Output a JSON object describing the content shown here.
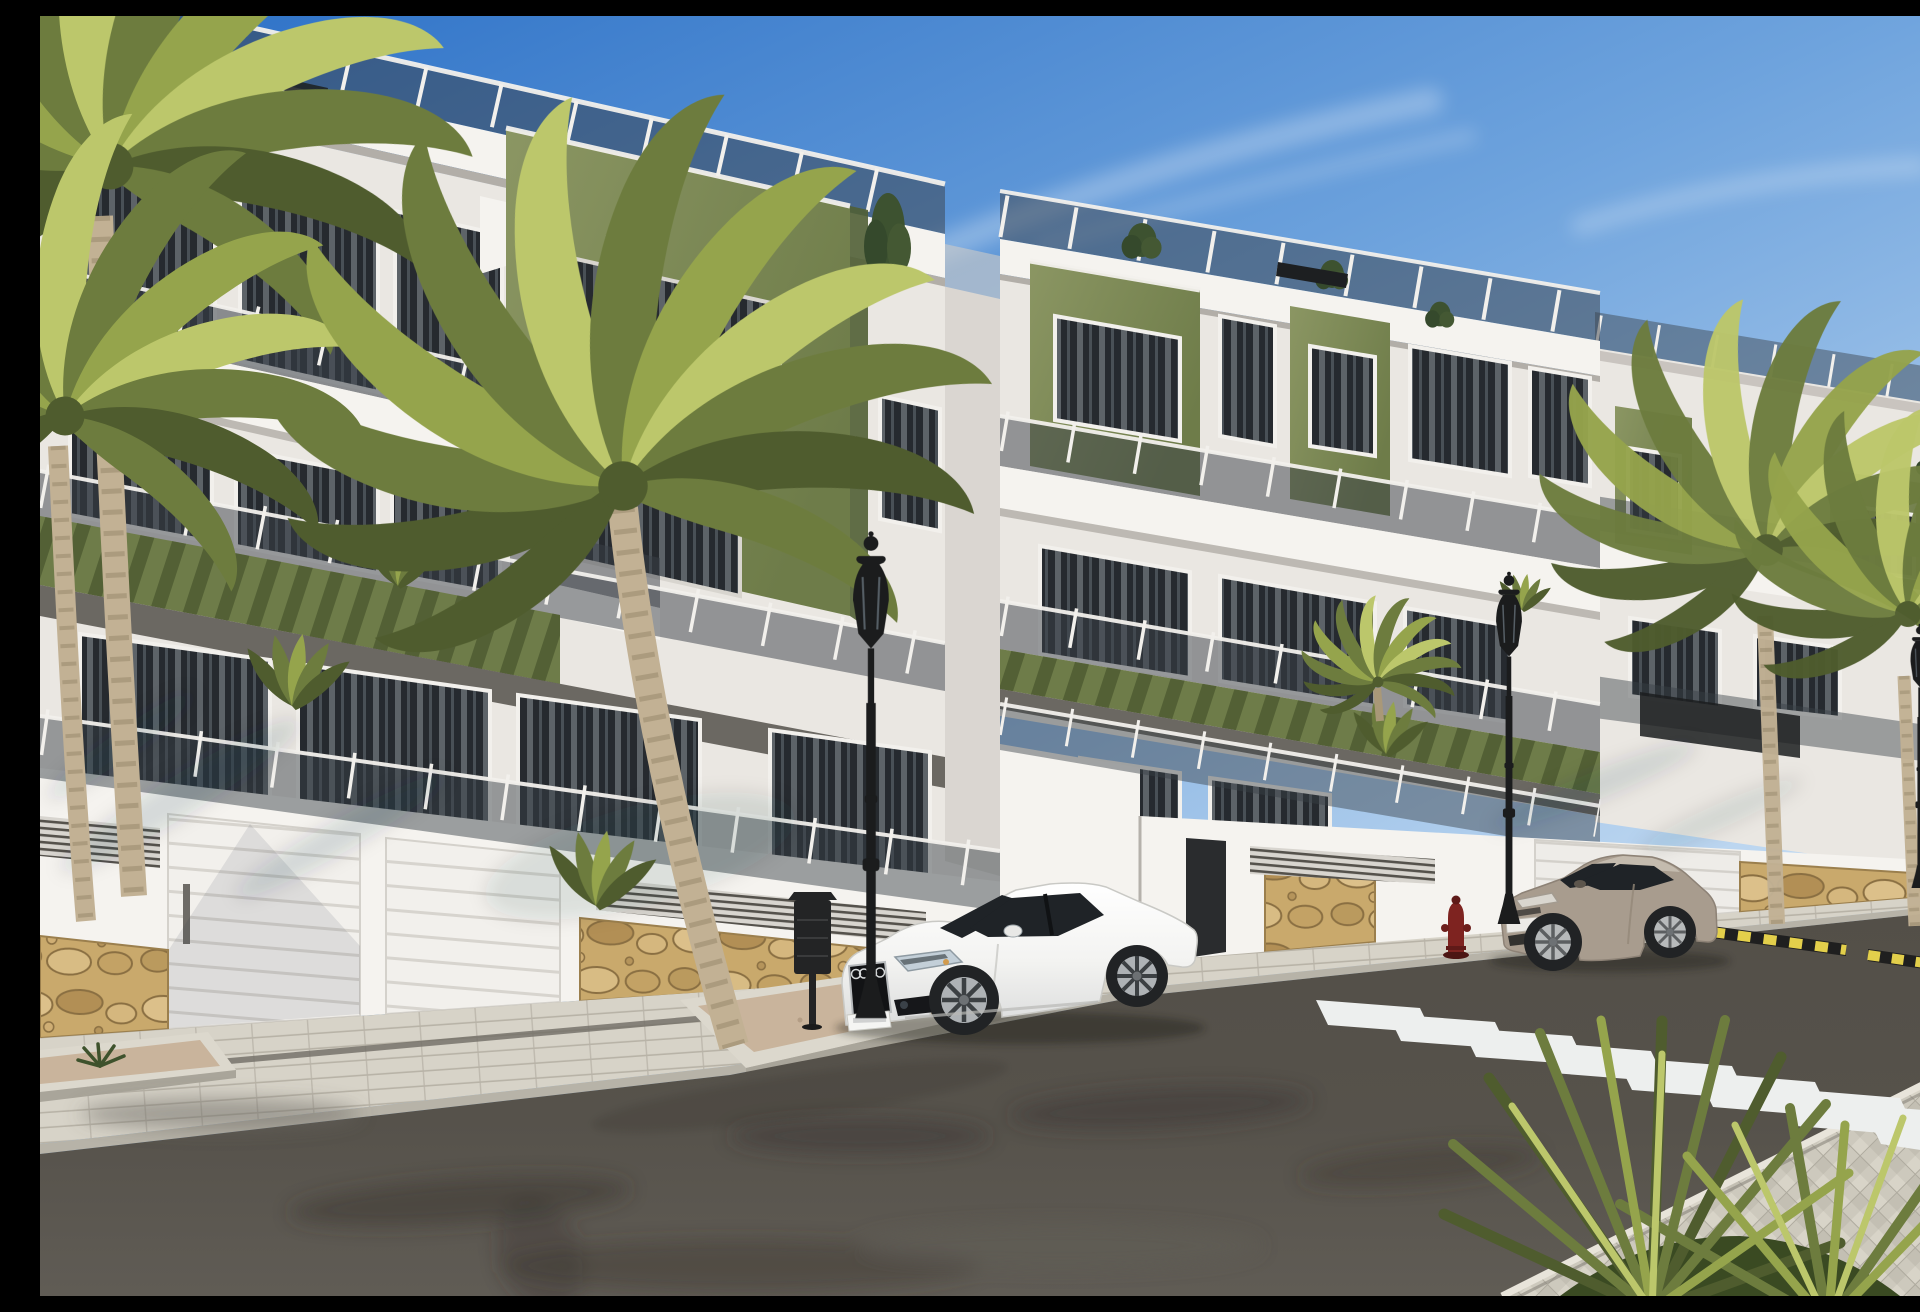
{
  "scene": {
    "type": "architectural_render",
    "title": "Modern apartment complex street view - sunny 3D render",
    "description": "Daytime 3D visualization of a new-build residential complex: white multi-storey apartment blocks with olive-green accent volumes, glass balcony railings, rooftop terraces with shrubs, a stone-clad base wall with white garage doors, palm trees, ornate black street lamps, a red fire hydrant, a zebra crossing and two parked coupes (one white, one beige).",
    "time_of_day": "day",
    "weather": "clear blue sky with wispy clouds"
  },
  "palette": {
    "sky_top": "#2a6fc6",
    "sky_mid": "#6ea3dd",
    "sky_horizon": "#d9e9f7",
    "white_sunlit": "#f5f3ef",
    "white_soft": "#eae7e2",
    "white_shade": "#cfccc6",
    "cornice_shadow": "#b2aea8",
    "green_light": "#8b9663",
    "green_mid": "#6e7c49",
    "green_dark": "#515f35",
    "glass_dark": "#23272c",
    "glass_tint": "#394048",
    "frame_white": "#f2f0ec",
    "stone_base": "#c9a96c",
    "paver": "#d7d3c8",
    "herringbone": "#cdc9bd",
    "asphalt": "#534f48",
    "asphalt_dark": "#3b3833",
    "asphalt_light": "#605c55",
    "crosswalk": "#edefee",
    "curb": "#e6e2d8",
    "gravel": "#c9b49c",
    "lamp_black": "#1b1c1d",
    "bin_black": "#232425",
    "hydrant_red": "#7e2320",
    "palm_dark": "#4f5c2e",
    "palm_mid": "#6d7c3e",
    "palm_light": "#95a44c",
    "palm_bright": "#bcc76b",
    "trunk": "#c2b194",
    "trunk_dark": "#99886b",
    "car_white": "#f6f6f4",
    "car_beige": "#a89c8e",
    "car_glass": "#1f2327",
    "mark_yellow": "#e3cf4b",
    "mark_black": "#1f1f1f"
  },
  "buildings": {
    "left_block": {
      "floors": 3,
      "features": [
        "rooftop glass railing",
        "white cornice",
        "olive-green accent volume",
        "glass balcony railings",
        "curtained windows",
        "green pergola slats",
        "ground-floor terraces",
        "street wall with molding",
        "two white garage doors",
        "louvered vent grilles",
        "stone cladding base"
      ]
    },
    "right_block": {
      "floors": 3,
      "features": [
        "rooftop glass railing",
        "two olive-green accent volumes",
        "glass balcony railings",
        "green pergola band",
        "garage door",
        "dark entrance gate",
        "stone cladding patches"
      ]
    },
    "far_right_block": {
      "partially_hidden_by_palms": true,
      "features": [
        "rooftop railing",
        "green accent volumes",
        "balcony slabs",
        "dark glass panels"
      ]
    }
  },
  "street": {
    "surface": "asphalt with wear stains",
    "crosswalk": {
      "stripe_count": 8,
      "direction": "diagonal toward bottom-right sidewalk"
    },
    "hazard_marking": {
      "colors": [
        "yellow",
        "black"
      ],
      "location": "right curb edge, two striped bars"
    },
    "lamps": {
      "count": 3,
      "style": "black ornate lantern post"
    },
    "furniture": [
      "black litter bin on post",
      "red fire hydrant"
    ],
    "sidewalks": [
      "left paver walk with drainage strip",
      "right paver strip",
      "bottom-right herringbone plaza"
    ],
    "planters": [
      "palm planter peninsula with gravel",
      "bottom-left gravel planter with agave"
    ]
  },
  "vehicles": [
    {
      "name": "white coupe",
      "position": "parked center-left, beside palm planter",
      "facing": "left",
      "license_plate": "illegible"
    },
    {
      "name": "beige coupe",
      "position": "parked right, before crosswalk",
      "facing": "left",
      "license_plate": "illegible"
    }
  ],
  "vegetation": {
    "palm_trees": {
      "left_edge_pair": 2,
      "center_large": 1,
      "right_pair": 2,
      "terrace_small": 1
    },
    "balcony_plants": 6,
    "rooftop_shrubs": 5,
    "corner_plant": {
      "type": "spiky yucca clump",
      "position": "bottom-right corner"
    }
  }
}
